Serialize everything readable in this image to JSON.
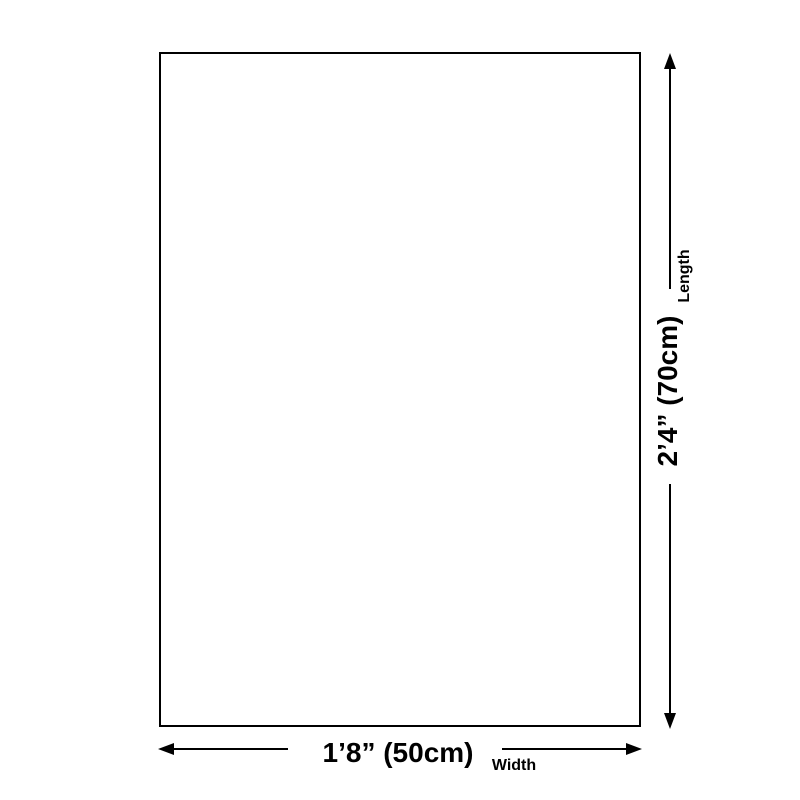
{
  "page": {
    "background_color": "#ffffff",
    "line_color": "#000000"
  },
  "diagram": {
    "type": "product-size-diagram",
    "length": {
      "value": "2’4” (70cm)",
      "label": "Length"
    },
    "width": {
      "value": "1’8” (50cm)",
      "label": "Width"
    }
  }
}
